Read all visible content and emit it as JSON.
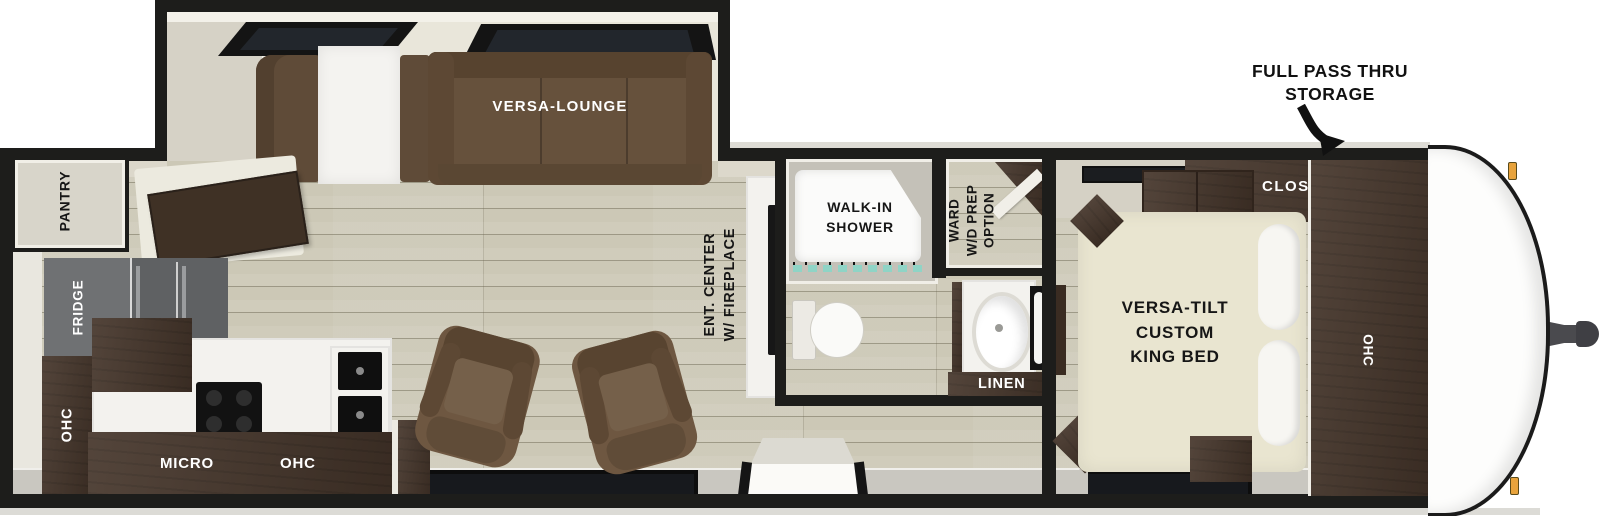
{
  "annotation": {
    "storage_line1": "FULL PASS THRU",
    "storage_line2": "STORAGE"
  },
  "slide_out": {
    "lounge_label": "VERSA-LOUNGE"
  },
  "kitchen": {
    "pantry_label": "PANTRY",
    "fridge_label": "FRIDGE",
    "ohc_left_label": "OHC",
    "micro_label": "MICRO",
    "ohc_counter_label": "OHC"
  },
  "living": {
    "ent_center_line1": "ENT. CENTER",
    "ent_center_line2": "W/ FIREPLACE"
  },
  "bathroom": {
    "shower_line1": "WALK-IN",
    "shower_line2": "SHOWER",
    "ward_line1": "WARD",
    "ward_line2": "W/D PREP",
    "ward_line3": "OPTION",
    "linen_label": "LINEN"
  },
  "bedroom": {
    "bed_line1": "VERSA-TILT",
    "bed_line2": "CUSTOM",
    "bed_line3": "KING BED",
    "closet_label": "CLOSET",
    "ohc_label": "OHC"
  },
  "colors": {
    "wall": "#1d1d1b",
    "floor_wood": "#ccc8b6",
    "cabinet_dark": "#45352a",
    "sofa_brown": "#66513c",
    "fridge_grey": "#6f7173",
    "bed_cream": "#e9e5d0",
    "shower_curtain_teal": "#8fd4c6",
    "marker_light_amber": "#e8a33c",
    "exterior_band_grey": "#c9c7c0"
  }
}
